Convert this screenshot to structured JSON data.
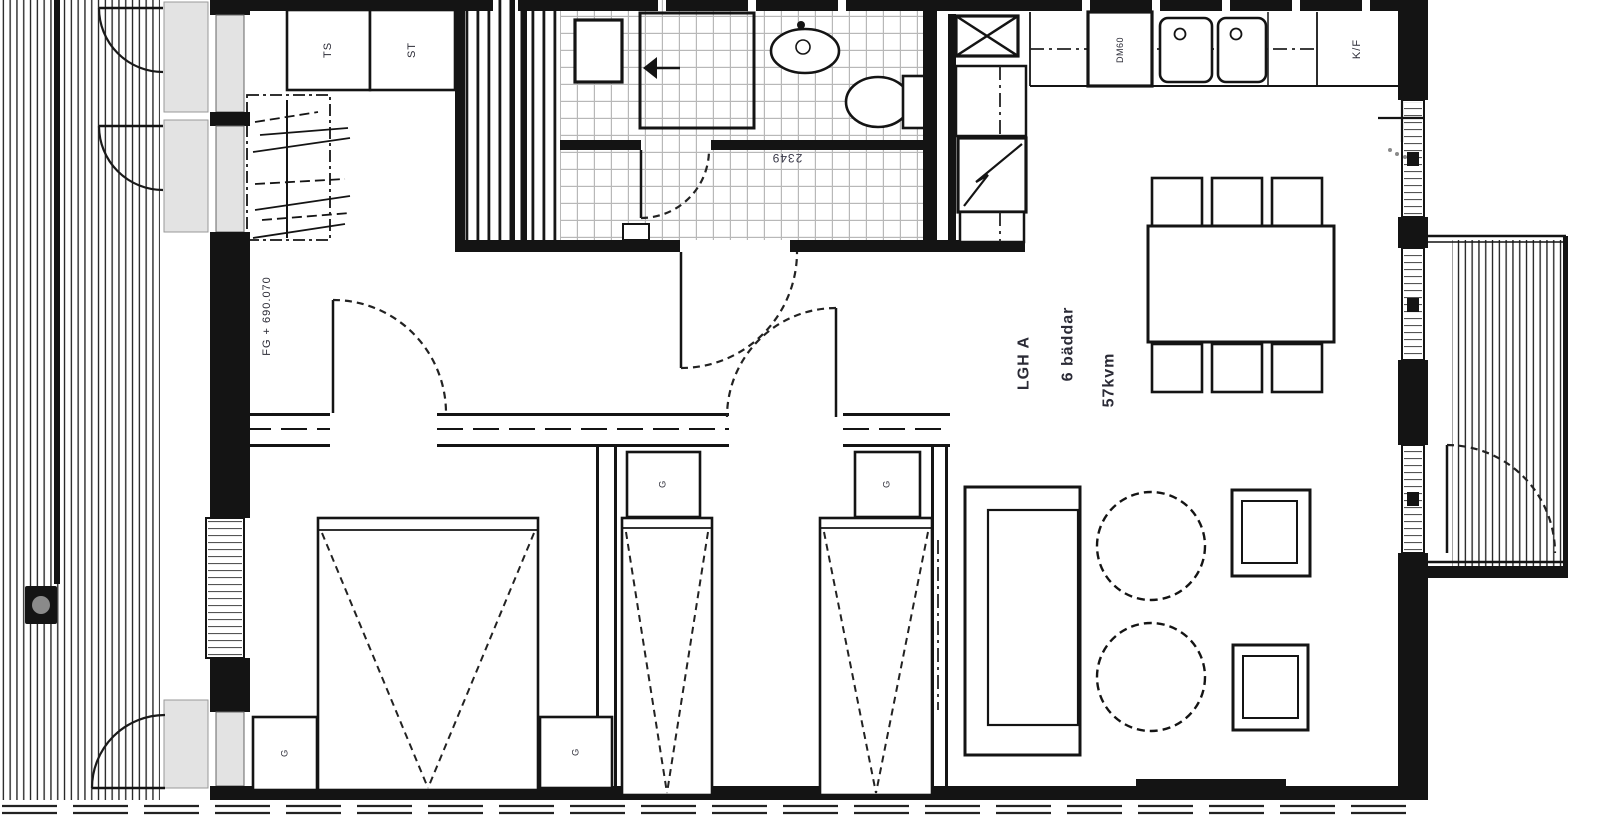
{
  "drawing": {
    "type": "architectural-floor-plan",
    "apartment": {
      "id": "LGH A",
      "beds": "6 bäddar",
      "area": "57kvm"
    },
    "annotations": {
      "floor_level": "FG + 690.070",
      "dimension": "2349"
    },
    "labels": {
      "closet_ts": "TS",
      "closet_st": "ST",
      "dishwasher": "DM60",
      "fridge_freezer": "K/F",
      "wardrobe": "G"
    },
    "colors": {
      "line": "#141414",
      "tile_grid": "#b8b8b8",
      "glass": "#e3e3e3",
      "label": "#2b2b36"
    }
  }
}
